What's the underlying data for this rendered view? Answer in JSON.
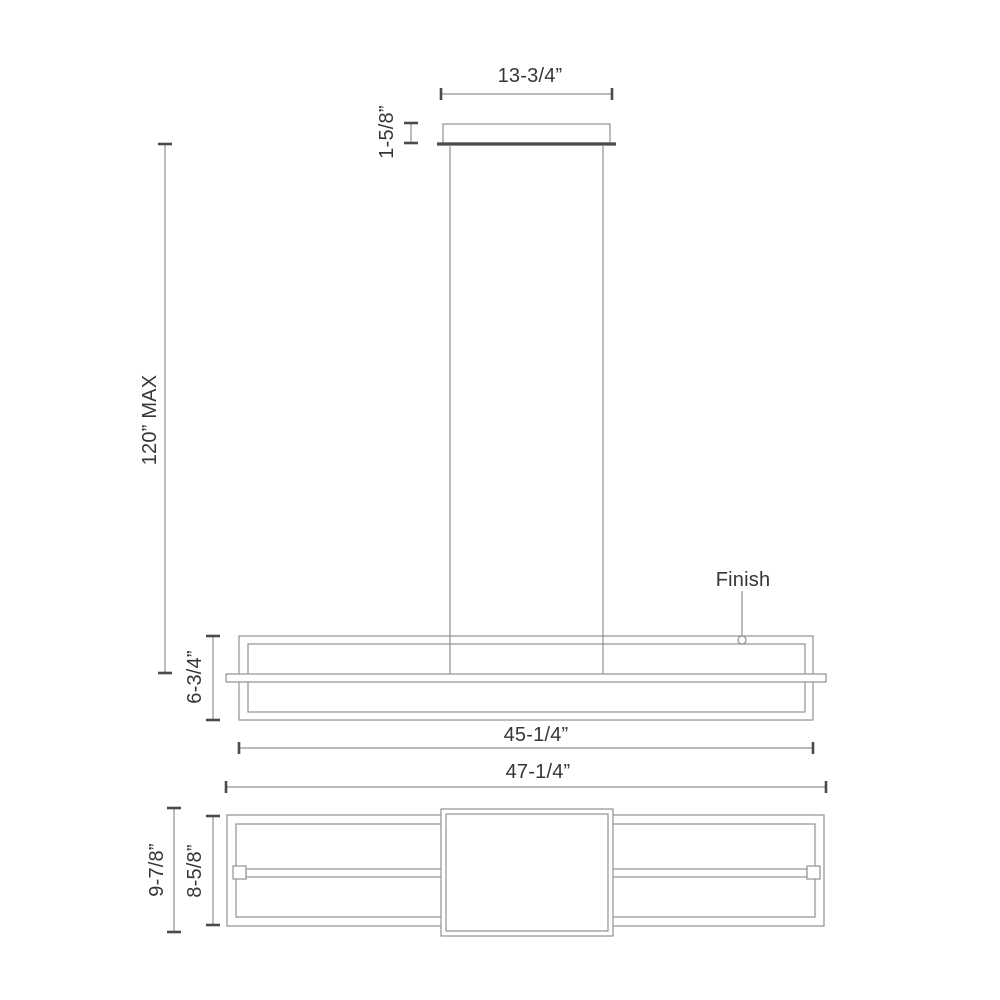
{
  "colors": {
    "line": "#8f9194",
    "dark": "#4b4b4d",
    "text": "#363639",
    "background": "#ffffff"
  },
  "drawing": {
    "type": "technical-dimension-drawing",
    "views": {
      "elevation": "linear pendant with ceiling canopy and two suspension cables",
      "plan": "rectangular frame with center driver box and LED bar"
    },
    "dimensions": {
      "canopy_width": "13-3/4”",
      "canopy_height": "1-5/8”",
      "suspension_max": "120” MAX",
      "fixture_height": "6-3/4”",
      "fixture_width": "45-1/4”",
      "overall_width": "47-1/4”",
      "plan_overall_depth": "9-7/8”",
      "plan_frame_depth": "8-5/8”"
    },
    "callouts": {
      "finish": "Finish"
    }
  }
}
